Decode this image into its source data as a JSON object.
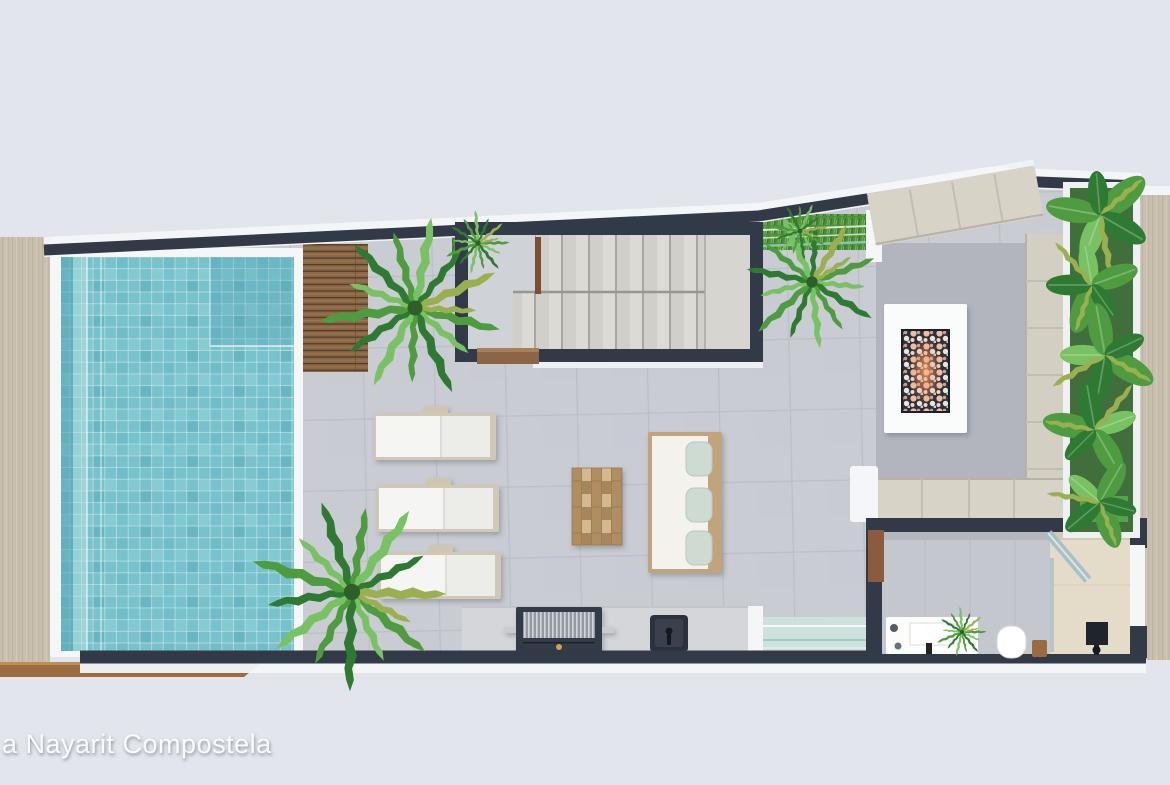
{
  "watermark": {
    "text": "a Nayarit Compostela"
  },
  "scene": {
    "description": "top-down 3D render of a rooftop terrace floor plan",
    "elements": [
      "swimming-pool",
      "pool-steps",
      "wood-deck",
      "palm-plants",
      "staircase",
      "stair-handrail",
      "wood-bench",
      "sun-loungers",
      "coffee-table",
      "sofa",
      "mint-pillows",
      "fire-pit",
      "sectional-sofa",
      "area-rug",
      "planter-wall",
      "glass-railing",
      "outdoor-kitchen",
      "bbq-grill",
      "kitchen-sink",
      "bathroom",
      "vanity",
      "vanity-plant",
      "toilet",
      "wood-stool",
      "shower",
      "shower-head",
      "glass-partition"
    ]
  },
  "colors": {
    "bg": "#e2e5eb",
    "wall": "#323a47",
    "white": "#f4f6f7",
    "floor": "#c9ccd2",
    "floor-line": "#bcc0c6",
    "pool": "#78c2cc",
    "pool-dark": "#4ea3b2",
    "pool-light": "#b8e2e2",
    "deck": "#8a6847",
    "beige": "#c8bfae",
    "cushion": "#d7d3c6",
    "rug": "#b2b5bd",
    "wood": "#c2a47c",
    "mint": "#cddbd2",
    "counter": "#d4d6da",
    "concrete": "#d2d6da",
    "fixture": "#2c323d",
    "glass": "#cfe3de",
    "grass": "#4e8f3c",
    "shower-floor": "#e4dcc8",
    "leaf": "#4f9c40",
    "leaf-light": "#79c263",
    "leaf-dark": "#2f7a33",
    "leaf-dry": "#9ab050",
    "fire-glow": "#ffb27a",
    "watermark": "#fbfcfd"
  }
}
